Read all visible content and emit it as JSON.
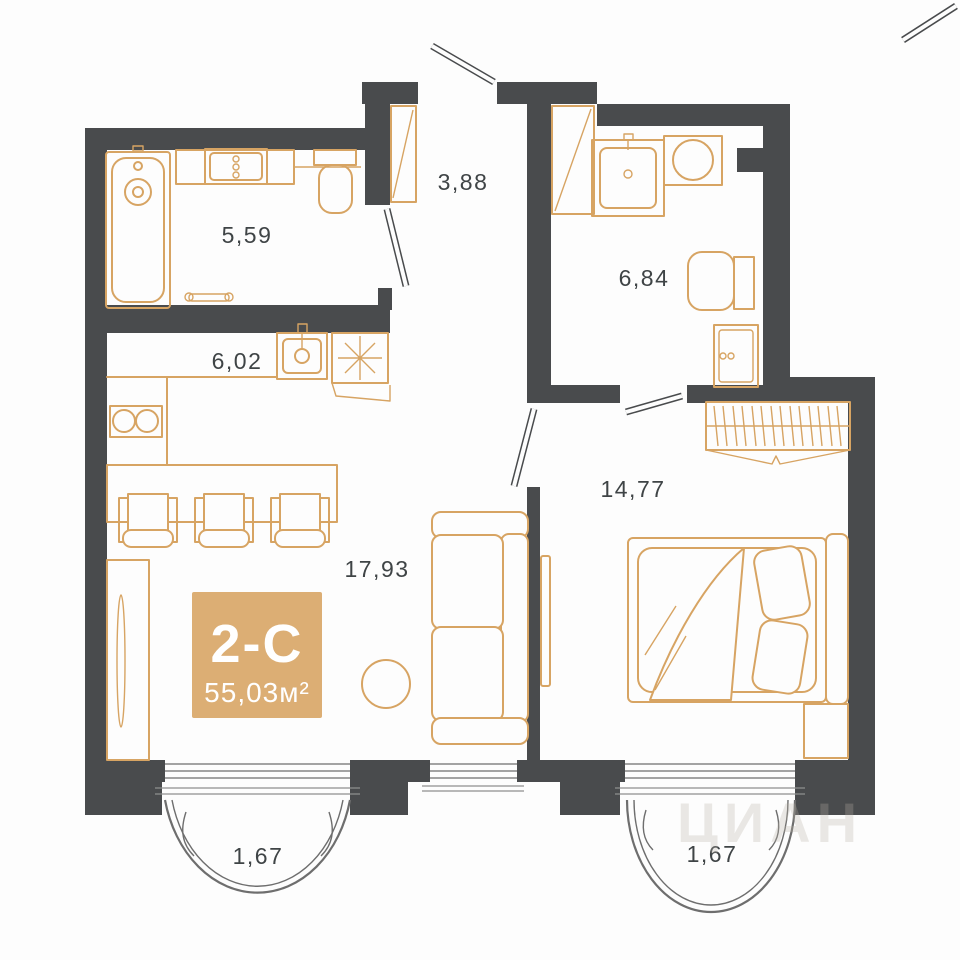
{
  "plan": {
    "badge": {
      "type": "2-С",
      "area": "55,03м²",
      "bg_color": "#dcae74",
      "text_color": "#ffffff"
    },
    "rooms": [
      {
        "id": "bathroom-1",
        "area_label": "5,59"
      },
      {
        "id": "hallway",
        "area_label": "3,88"
      },
      {
        "id": "bathroom-2",
        "area_label": "6,84"
      },
      {
        "id": "kitchen",
        "area_label": "6,02"
      },
      {
        "id": "living-room",
        "area_label": "17,93"
      },
      {
        "id": "bedroom",
        "area_label": "14,77"
      },
      {
        "id": "balcony-left",
        "area_label": "1,67"
      },
      {
        "id": "balcony-right",
        "area_label": "1,67"
      }
    ],
    "watermark": {
      "text": "ЦИАН"
    },
    "colors": {
      "wall": "#494b4d",
      "furniture": "#d7a463",
      "label": "#3f4446",
      "badge_bg": "#dcae74"
    }
  }
}
